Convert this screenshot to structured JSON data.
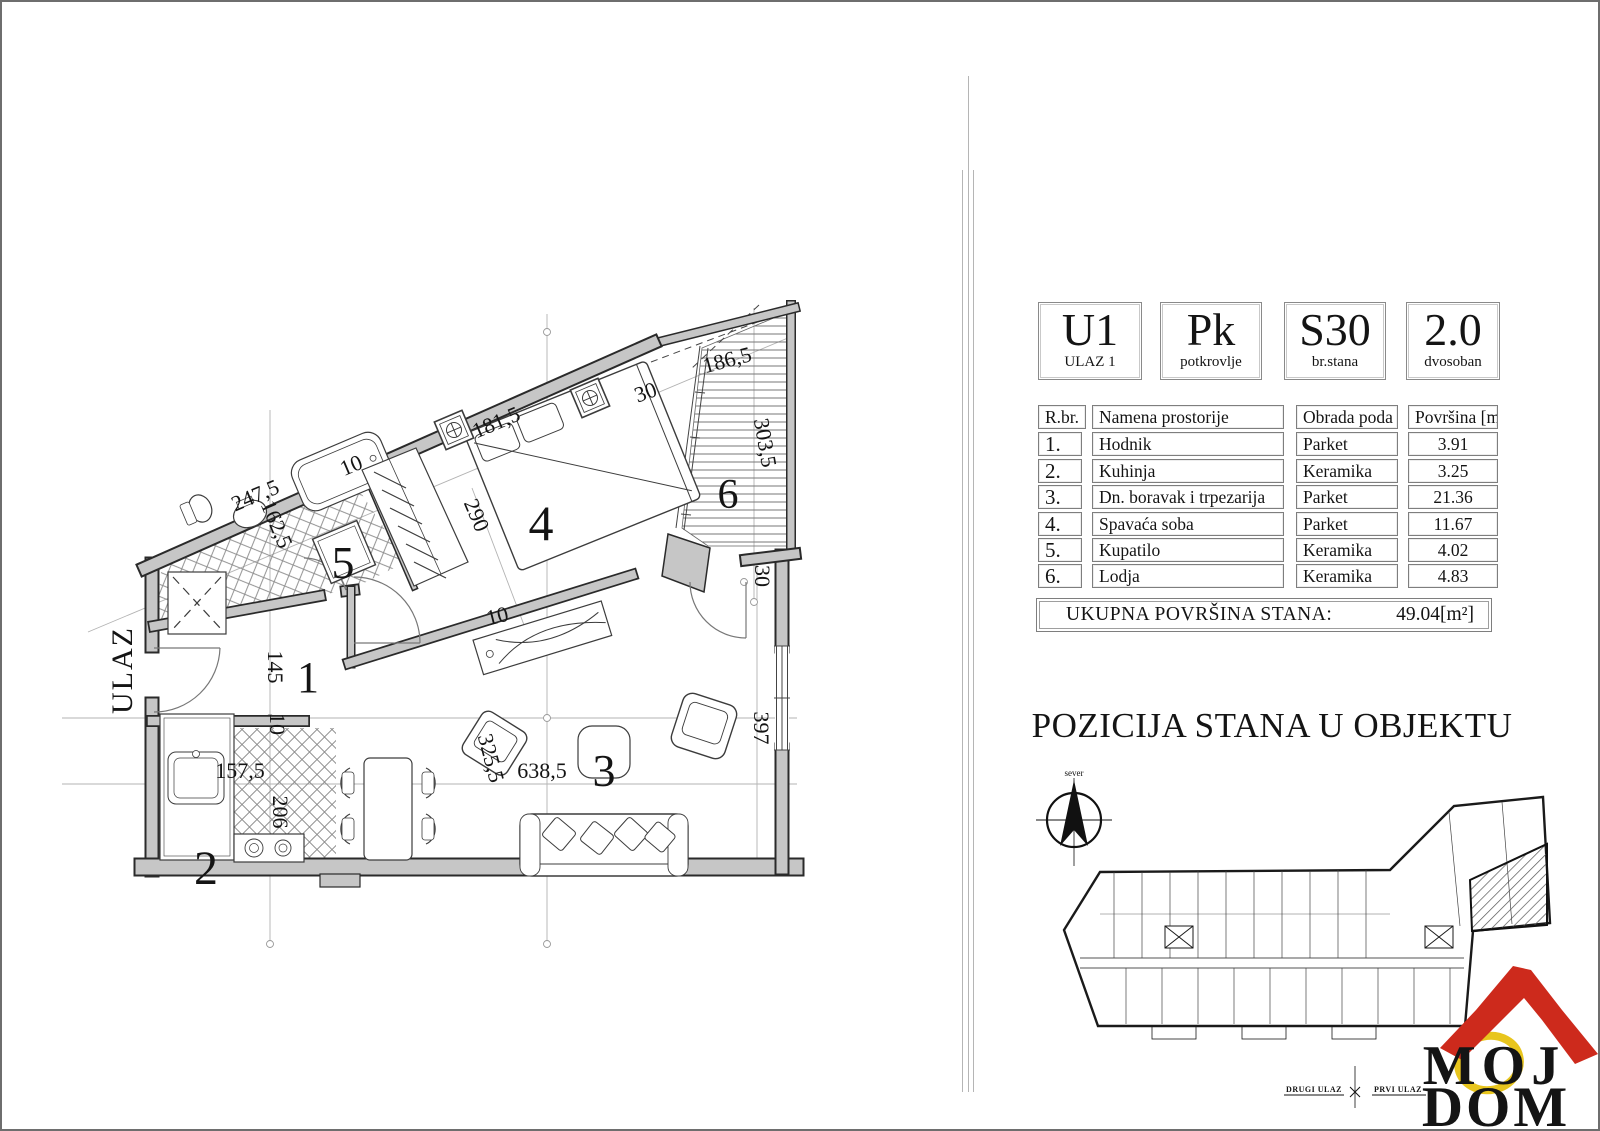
{
  "page": {
    "background": "#ffffff",
    "border_color": "#6e6e6e"
  },
  "unit_header": [
    {
      "big": "U1",
      "small": "ULAZ 1"
    },
    {
      "big": "Pk",
      "small": "potkrovlje"
    },
    {
      "big": "S30",
      "small": "br.stana"
    },
    {
      "big": "2.0",
      "small": "dvosoban"
    }
  ],
  "rooms_table": {
    "columns": [
      "R.br.",
      "Namena prostorije",
      "Obrada poda",
      "Površina [m²]"
    ],
    "rows": [
      {
        "num": "1.",
        "name": "Hodnik",
        "floor": "Parket",
        "area": "3.91"
      },
      {
        "num": "2.",
        "name": "Kuhinja",
        "floor": "Keramika",
        "area": "3.25"
      },
      {
        "num": "3.",
        "name": "Dn. boravak i trpezarija",
        "floor": "Parket",
        "area": "21.36"
      },
      {
        "num": "4.",
        "name": "Spavaća soba",
        "floor": "Parket",
        "area": "11.67"
      },
      {
        "num": "5.",
        "name": "Kupatilo",
        "floor": "Keramika",
        "area": "4.02"
      },
      {
        "num": "6.",
        "name": "Lodja",
        "floor": "Keramika",
        "area": "4.83"
      }
    ]
  },
  "total": {
    "label": "UKUPNA POVRŠINA STANA:",
    "value": "49.04[m²]"
  },
  "position_section": {
    "title": "POZICIJA STANA U OBJEKTU",
    "compass_label": "sever",
    "entrance_left": "DRUGI ULAZ",
    "entrance_right": "PRVI ULAZ"
  },
  "logo": {
    "word1": "MOJ",
    "word2": "DOM",
    "roof_color": "#cd2a1c",
    "ring_color": "#e8c51d"
  },
  "floorplan": {
    "entrance_label": "ULAZ",
    "wall_color": "#c6c6c6",
    "rooms": {
      "r1": "1",
      "r2": "2",
      "r3": "3",
      "r4": "4",
      "r5": "5",
      "r6": "6"
    },
    "dims": {
      "d247": "247,5",
      "d162": "162,5",
      "d181": "181,5",
      "d290": "290",
      "d186": "186,5",
      "d303": "303,5",
      "d145": "145",
      "d157": "157,5",
      "d206": "206",
      "d638": "638,5",
      "d325": "325,5",
      "d397": "397",
      "d30": "30",
      "d10": "10"
    }
  }
}
